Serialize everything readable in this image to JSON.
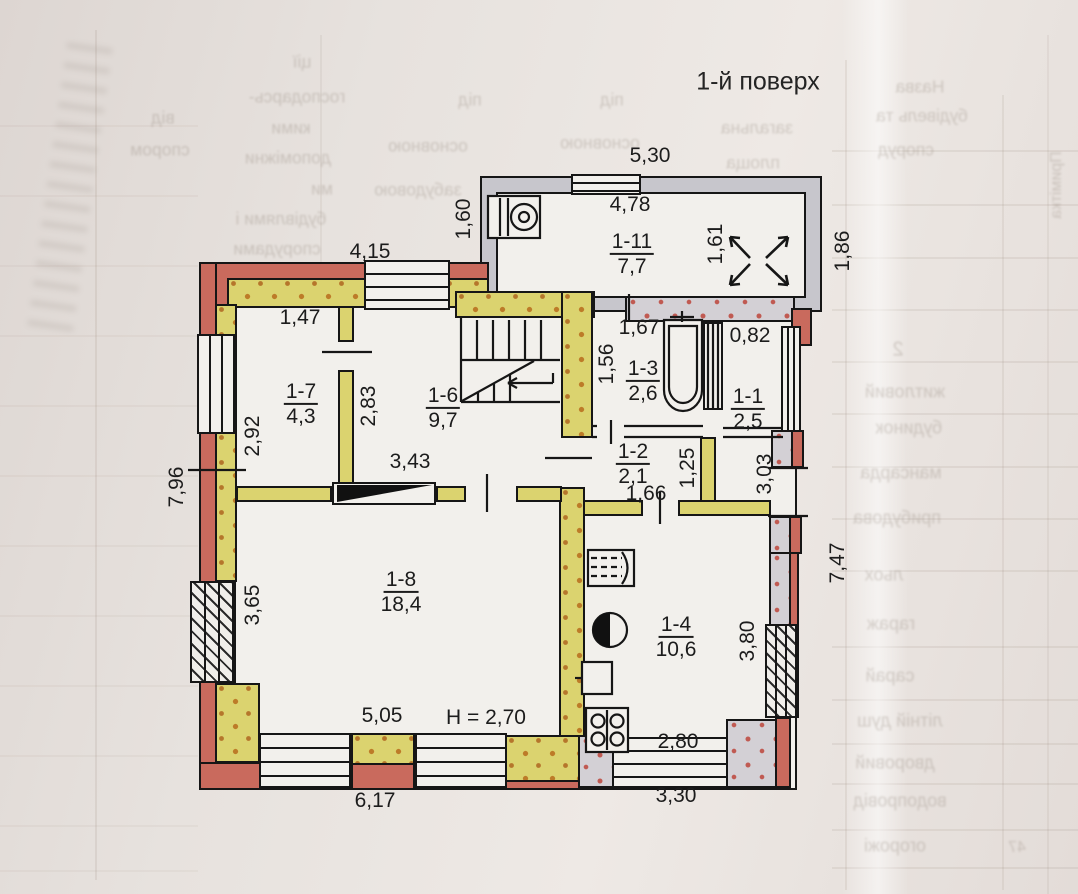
{
  "title": "1-й поверх",
  "floor_plan": {
    "floor_height_note": "H = 2,70",
    "rooms": [
      {
        "id": "1-11",
        "area": "7,7",
        "x": 632,
        "y": 254
      },
      {
        "id": "1-7",
        "area": "4,3",
        "x": 301,
        "y": 404
      },
      {
        "id": "1-6",
        "area": "9,7",
        "x": 443,
        "y": 408
      },
      {
        "id": "1-3",
        "area": "2,6",
        "x": 643,
        "y": 381
      },
      {
        "id": "1-1",
        "area": "2,5",
        "x": 748,
        "y": 409
      },
      {
        "id": "1-2",
        "area": "2,1",
        "x": 633,
        "y": 464
      },
      {
        "id": "1-8",
        "area": "18,4",
        "x": 401,
        "y": 592
      },
      {
        "id": "1-4",
        "area": "10,6",
        "x": 676,
        "y": 637
      }
    ],
    "dimensions": [
      {
        "text": "5,30",
        "x": 650,
        "y": 156,
        "rot": 0
      },
      {
        "text": "4,78",
        "x": 630,
        "y": 205,
        "rot": 0
      },
      {
        "text": "1,60",
        "x": 464,
        "y": 219,
        "rot": -90
      },
      {
        "text": "1,61",
        "x": 716,
        "y": 244,
        "rot": -90
      },
      {
        "text": "1,86",
        "x": 843,
        "y": 251,
        "rot": -90
      },
      {
        "text": "4,15",
        "x": 370,
        "y": 252,
        "rot": 0
      },
      {
        "text": "1,47",
        "x": 300,
        "y": 318,
        "rot": 0
      },
      {
        "text": "1,67",
        "x": 639,
        "y": 328,
        "rot": 0
      },
      {
        "text": "0,82",
        "x": 750,
        "y": 336,
        "rot": 0
      },
      {
        "text": "1,56",
        "x": 607,
        "y": 364,
        "rot": -90
      },
      {
        "text": "2,83",
        "x": 369,
        "y": 406,
        "rot": -90
      },
      {
        "text": "2,92",
        "x": 253,
        "y": 436,
        "rot": -90
      },
      {
        "text": "3,43",
        "x": 410,
        "y": 462,
        "rot": 0
      },
      {
        "text": "1,25",
        "x": 688,
        "y": 468,
        "rot": -90
      },
      {
        "text": "3,03",
        "x": 765,
        "y": 474,
        "rot": -90
      },
      {
        "text": "7,96",
        "x": 177,
        "y": 487,
        "rot": -90
      },
      {
        "text": "1,66",
        "x": 646,
        "y": 494,
        "rot": 0
      },
      {
        "text": "3,65",
        "x": 253,
        "y": 605,
        "rot": -90
      },
      {
        "text": "3,80",
        "x": 748,
        "y": 641,
        "rot": -90
      },
      {
        "text": "7,47",
        "x": 838,
        "y": 563,
        "rot": -90
      },
      {
        "text": "5,05",
        "x": 382,
        "y": 716,
        "rot": 0
      },
      {
        "text": "H = 2,70",
        "x": 486,
        "y": 718,
        "rot": 0
      },
      {
        "text": "2,80",
        "x": 678,
        "y": 742,
        "rot": 0
      },
      {
        "text": "6,17",
        "x": 375,
        "y": 801,
        "rot": 0
      },
      {
        "text": "3,30",
        "x": 676,
        "y": 796,
        "rot": 0
      }
    ]
  },
  "bleed_text": {
    "items": [
      {
        "text": "Назва",
        "x": 920,
        "y": 87
      },
      {
        "text": "будівель та",
        "x": 922,
        "y": 116
      },
      {
        "text": "споруд",
        "x": 906,
        "y": 150
      },
      {
        "text": "загальна",
        "x": 757,
        "y": 128
      },
      {
        "text": "площа",
        "x": 753,
        "y": 163
      },
      {
        "text": "під",
        "x": 470,
        "y": 100
      },
      {
        "text": "основною",
        "x": 428,
        "y": 146
      },
      {
        "text": "забудовою",
        "x": 418,
        "y": 190
      },
      {
        "text": "під",
        "x": 612,
        "y": 100
      },
      {
        "text": "основною",
        "x": 600,
        "y": 143
      },
      {
        "text": "забудовою",
        "x": 590,
        "y": 186
      },
      {
        "text": "ції",
        "x": 302,
        "y": 62
      },
      {
        "text": "господарсь-",
        "x": 297,
        "y": 97
      },
      {
        "text": "кими",
        "x": 291,
        "y": 128
      },
      {
        "text": "допоміжни",
        "x": 288,
        "y": 158
      },
      {
        "text": "ми",
        "x": 322,
        "y": 189
      },
      {
        "text": "будівлями і",
        "x": 281,
        "y": 219
      },
      {
        "text": "спорудами",
        "x": 277,
        "y": 249
      },
      {
        "text": "від",
        "x": 163,
        "y": 118
      },
      {
        "text": "спором",
        "x": 160,
        "y": 150
      },
      {
        "text": "2",
        "x": 898,
        "y": 350,
        "fs": 20
      },
      {
        "text": "житловий",
        "x": 905,
        "y": 392,
        "fs": 18
      },
      {
        "text": "будинок",
        "x": 909,
        "y": 428,
        "fs": 18
      },
      {
        "text": "мансарда",
        "x": 901,
        "y": 473,
        "fs": 18
      },
      {
        "text": "прибудова",
        "x": 897,
        "y": 518,
        "fs": 18
      },
      {
        "text": "льох",
        "x": 884,
        "y": 575,
        "fs": 18
      },
      {
        "text": "гараж",
        "x": 891,
        "y": 624,
        "fs": 18
      },
      {
        "text": "сарай",
        "x": 890,
        "y": 676,
        "fs": 18
      },
      {
        "text": "літній душ",
        "x": 900,
        "y": 721,
        "fs": 18
      },
      {
        "text": "дворовий",
        "x": 895,
        "y": 763,
        "fs": 18
      },
      {
        "text": "водопровід",
        "x": 900,
        "y": 801,
        "fs": 18
      },
      {
        "text": "огорожі",
        "x": 895,
        "y": 846,
        "fs": 18
      },
      {
        "text": "47",
        "x": 1017,
        "y": 848,
        "fs": 16
      },
      {
        "text": "Примітка",
        "x": 1057,
        "y": 185,
        "fs": 16,
        "rot": 90
      },
      {
        "text": "5",
        "x": 306,
        "y": 334,
        "fs": 15
      }
    ]
  },
  "colors": {
    "wall_red": "#c96a5d",
    "wall_yellow": "#dbd36f",
    "wall_gray": "#c7c6cc",
    "wall_gray_dotted": "#d3d0d5",
    "dot_orange": "#bd7b28",
    "dot_red": "#c05a52",
    "outline": "#161616",
    "paper": "#e8e3df",
    "floor": "#f2f0ec"
  }
}
